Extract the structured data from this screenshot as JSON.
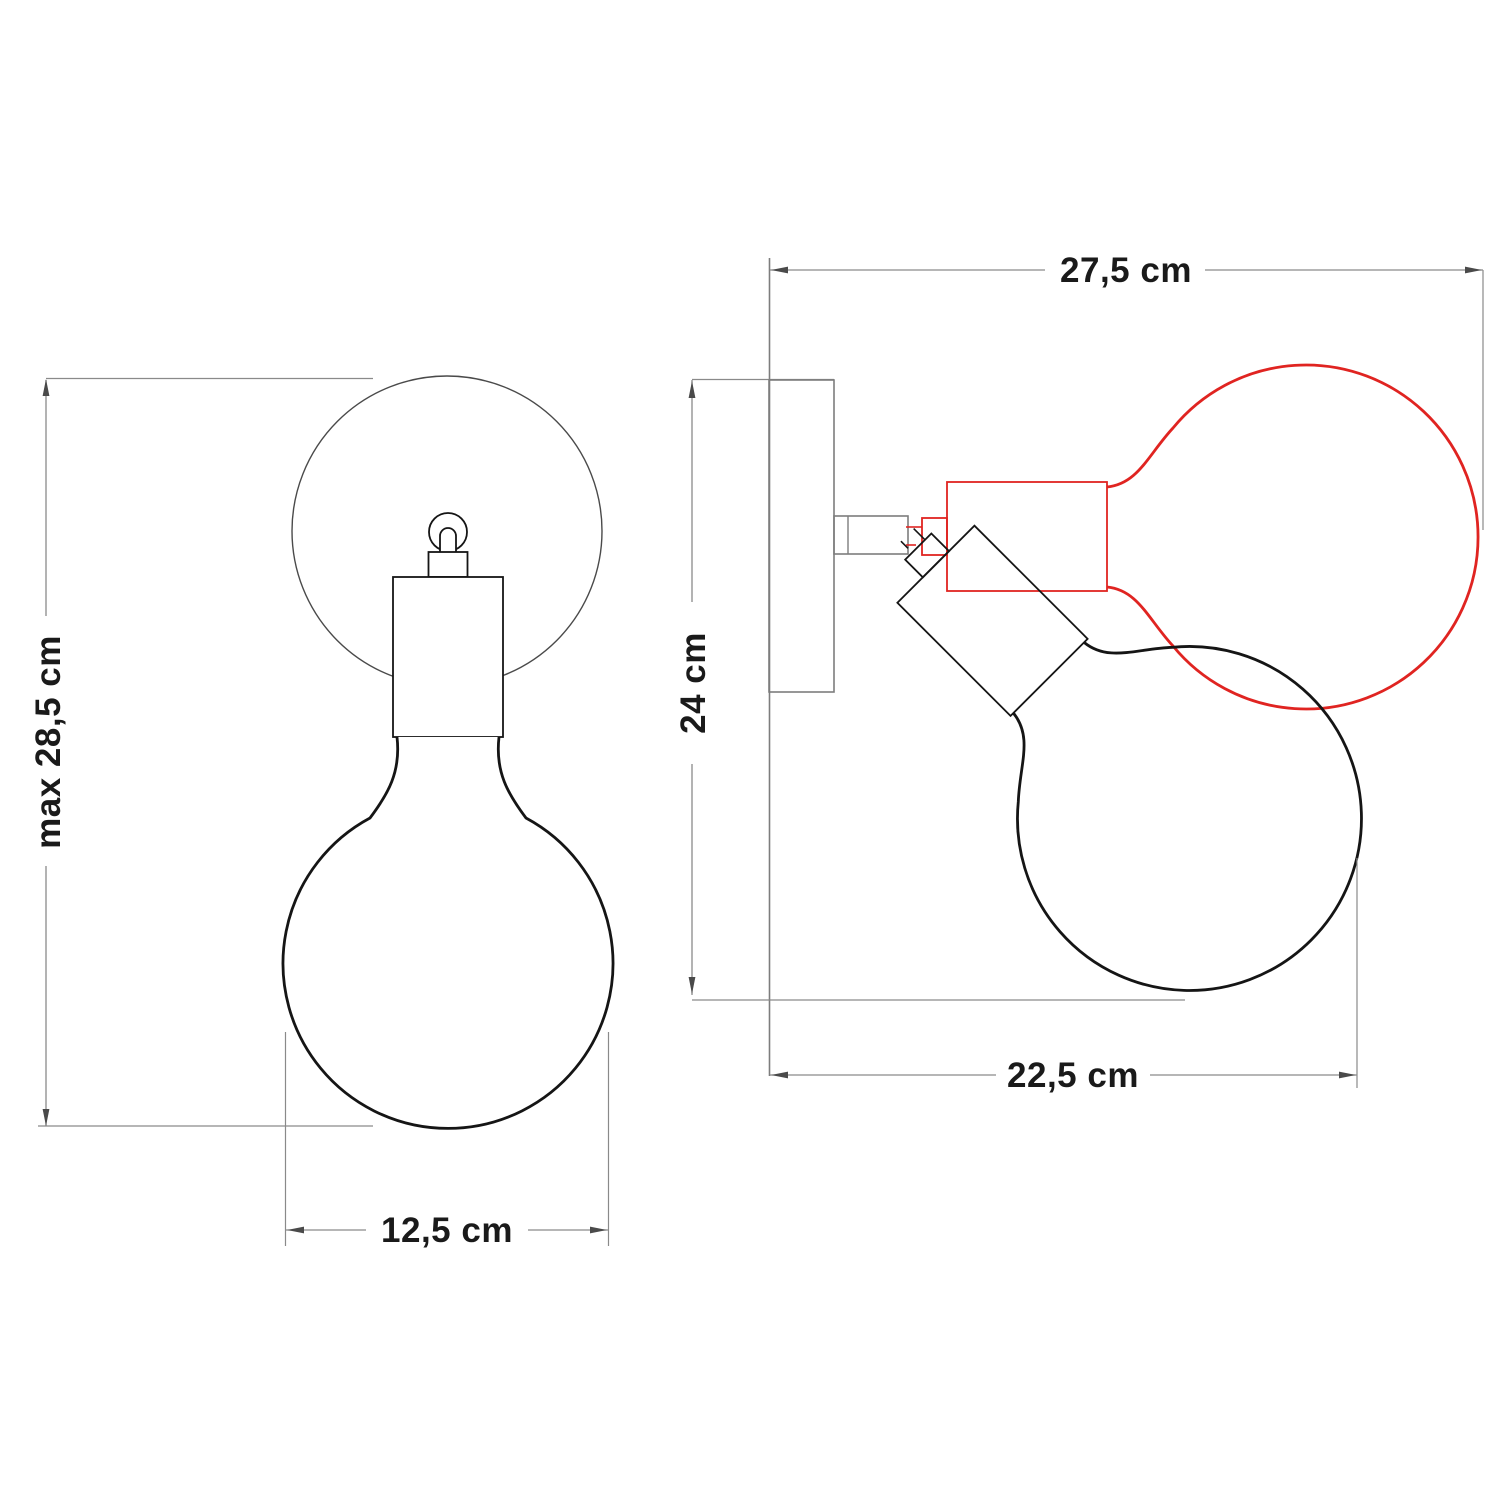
{
  "drawing": {
    "type": "technical-dimension-drawing",
    "subject": "adjustable wall lamp with globe bulb, front and side views with alternate bulb position",
    "front_view": {
      "dim_height_label": "max 28,5 cm",
      "dim_width_label": "12,5 cm"
    },
    "side_view": {
      "dim_total_label": "27,5 cm",
      "dim_height_label": "24 cm",
      "dim_depth_label": "22,5 cm"
    },
    "colors": {
      "background": "#ffffff",
      "line_dark": "#151515",
      "outline_mid": "#4a4a4a",
      "plate_gray": "#7d7d7d",
      "line_gray": "#8a8a8a",
      "text_dark": "#1a1a1a",
      "alt_position_red": "#e02421"
    }
  }
}
